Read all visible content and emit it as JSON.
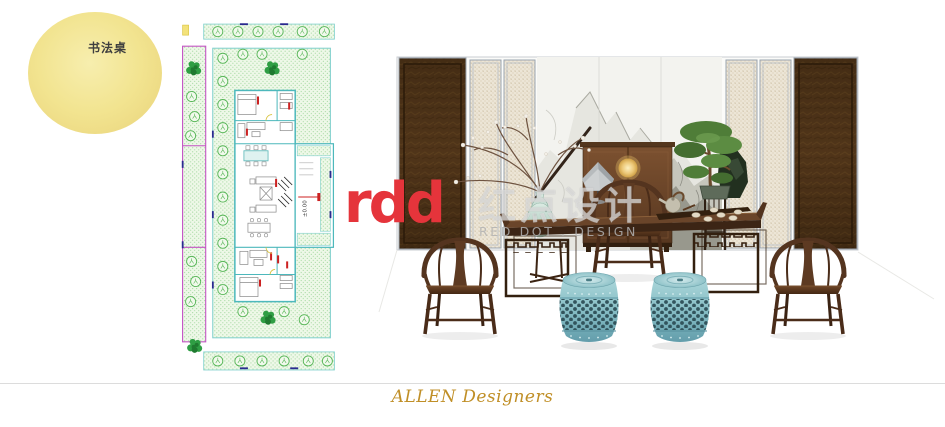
{
  "slide": {
    "bubble": {
      "label": "书法桌",
      "fill": "#f2e490",
      "text_color": "#3f3f3f"
    },
    "floor_plan": {
      "elevation_label": "±0.00",
      "hatch_green": "#a4d8a0",
      "wall_cyan": "#4db8bc",
      "boundary_magenta": "#c455c4",
      "tree_green": "#57b657",
      "annotation_red": "#cc2222"
    },
    "scene": {
      "wood_dark": "#4a2d1c",
      "stool_teal": "#8cc4ca",
      "marble_gray": "#b9b9b2",
      "lamp_gold": "#e8c06a"
    },
    "watermark": {
      "logo": "rdd",
      "logo_color": "#e5343b",
      "cn": "红点设计",
      "en": "RED DOT . DESIGN"
    },
    "footer": {
      "brand": "ALLEN Designers",
      "color": "#c08f27"
    }
  }
}
